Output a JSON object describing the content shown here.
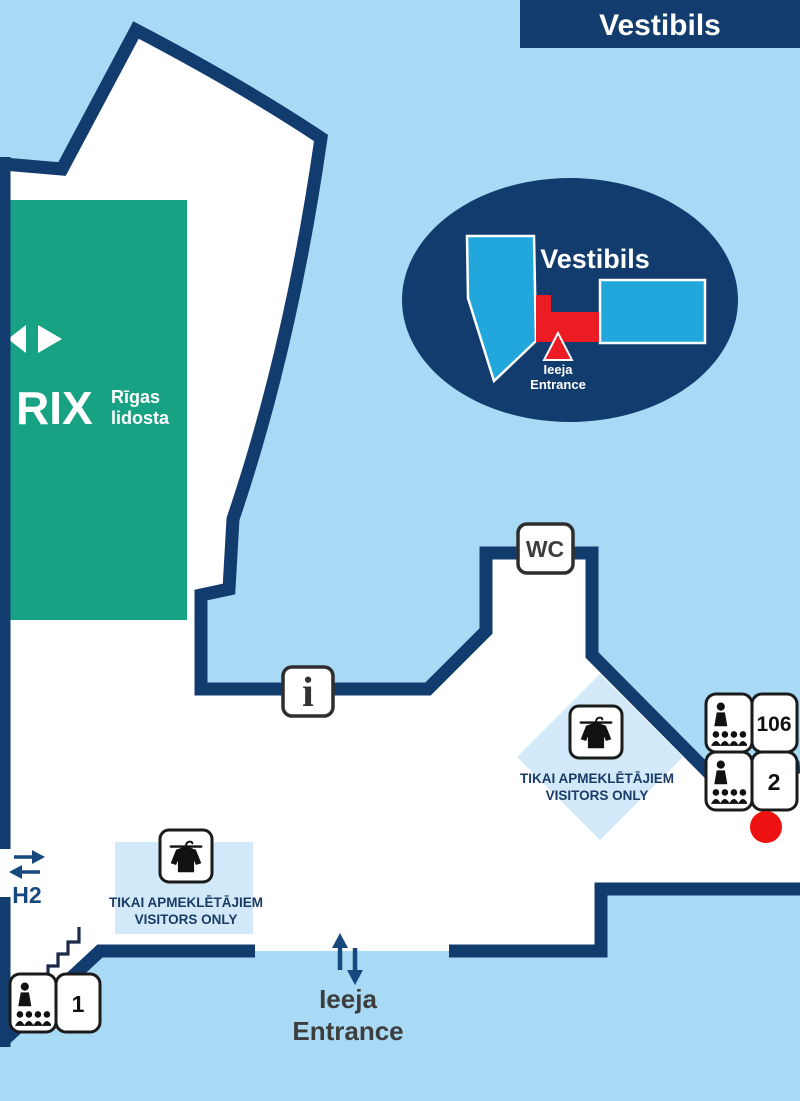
{
  "banner": {
    "title": "Vestibils"
  },
  "inset_map": {
    "title": "Vestibils",
    "entrance_line1": "Ieeja",
    "entrance_line2": "Entrance"
  },
  "airport_logo": {
    "name": "RIX",
    "tagline_line1": "Rīgas",
    "tagline_line2": "lidosta"
  },
  "signs": {
    "wc": "WC",
    "info": "i",
    "room_numbers": [
      "106",
      "2",
      "1"
    ]
  },
  "coat_check": {
    "line1": "TIKAI APMEKLĒTĀJIEM",
    "line2": "VISITORS ONLY"
  },
  "doors": {
    "h2": "H2"
  },
  "entrance": {
    "line1": "Ieeja",
    "line2": "Entrance"
  },
  "colors": {
    "background": "#A8DAF5",
    "wall": "#123C6E",
    "floor": "#FFFFFF",
    "green": "#17A283",
    "cyan": "#21A7DB",
    "red": "#EC1C24",
    "pale_blue": "#D1E9F8",
    "marker_red": "#EE1111",
    "dark_text": "#3D3D3D",
    "navy_text": "#1A3B66",
    "arrow_navy": "#17497E"
  }
}
